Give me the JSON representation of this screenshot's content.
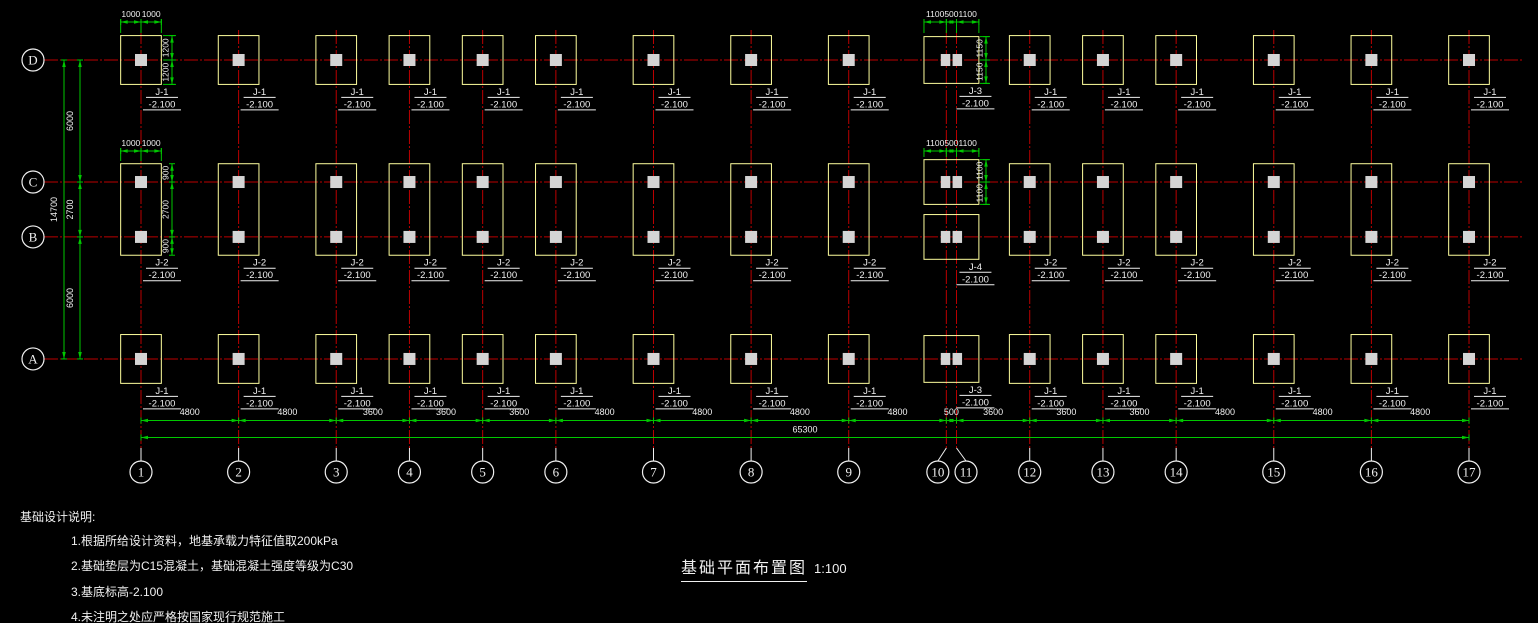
{
  "drawing": {
    "title": "基础平面布置图",
    "scale": "1:100",
    "notes_heading": "基础设计说明:",
    "notes": [
      "1.根据所给设计资料，地基承载力特征值取200kPa",
      "2.基础垫层为C15混凝土，基础混凝土强度等级为C30",
      "3.基底标高-2.100",
      "4.未注明之处应严格按国家现行规范施工"
    ]
  },
  "colors": {
    "background": "#000000",
    "grid_line": "#bb0000",
    "dimension": "#00c800",
    "footing_outline": "#ffff9e",
    "column_fill": "#d4d4d4",
    "text": "#f0f0f0",
    "bubble_stroke": "#f0f0f0"
  },
  "grid": {
    "vertical": {
      "labels": [
        "1",
        "2",
        "3",
        "4",
        "5",
        "6",
        "7",
        "8",
        "9",
        "10",
        "11",
        "12",
        "13",
        "14",
        "15",
        "16",
        "17"
      ],
      "spacings_mm": [
        4800,
        4800,
        3600,
        3600,
        3600,
        4800,
        4800,
        4800,
        4800,
        500,
        3600,
        3600,
        3600,
        4800,
        4800,
        4800
      ],
      "overall": "65300"
    },
    "horizontal": {
      "labels": [
        "D",
        "C",
        "B",
        "A"
      ],
      "spacings_mm": [
        6000,
        2700,
        6000
      ],
      "overall": "14700"
    }
  },
  "dimensions": {
    "bottom_segments": [
      "4800",
      "4800",
      "3600",
      "3600",
      "3600",
      "4800",
      "4800",
      "4800",
      "4800",
      "500",
      "3600",
      "3600",
      "3600",
      "4800",
      "4800",
      "4800"
    ],
    "bottom_overall": "65300",
    "left_segments": [
      "6000",
      "2700",
      "6000"
    ],
    "left_overall": "14700",
    "details": {
      "j1_top": [
        "1000",
        "1000"
      ],
      "j1_side": [
        "1200",
        "1200"
      ],
      "j2_top": [
        "1000",
        "1000"
      ],
      "j2_side": [
        "900",
        "2700",
        "900"
      ],
      "j3_top": [
        "1100",
        "500",
        "1100"
      ],
      "j3_side": [
        "1150",
        "1150"
      ],
      "j4_top": [
        "1100",
        "500",
        "1100"
      ],
      "j4_side": [
        "1100",
        "1100"
      ]
    }
  },
  "footing_types": {
    "J1": {
      "label": "J-1",
      "elevation": "-2.100",
      "width_mm": 2000,
      "depth_mm": 2400
    },
    "J2": {
      "label": "J-2",
      "elevation": "-2.100",
      "width_mm": 2000,
      "depth_mm": 4500
    },
    "J3": {
      "label": "J-3",
      "elevation": "-2.100",
      "width_mm": 2700,
      "depth_mm": 2300
    },
    "J4": {
      "label": "J-4",
      "elevation": "-2.100",
      "width_mm": 2700,
      "depth_mm": 2200
    }
  },
  "layout": {
    "standard_grid_indices": [
      0,
      1,
      2,
      3,
      4,
      5,
      6,
      7,
      8,
      11,
      12,
      13,
      14,
      15,
      16
    ],
    "special_pair_indices": [
      9,
      10
    ],
    "rows": [
      {
        "name": "D",
        "standard": "J1",
        "special": "J3"
      },
      {
        "name": "CB",
        "standard": "J2",
        "special": "J4"
      },
      {
        "name": "A",
        "standard": "J1",
        "special": "J3"
      }
    ]
  }
}
